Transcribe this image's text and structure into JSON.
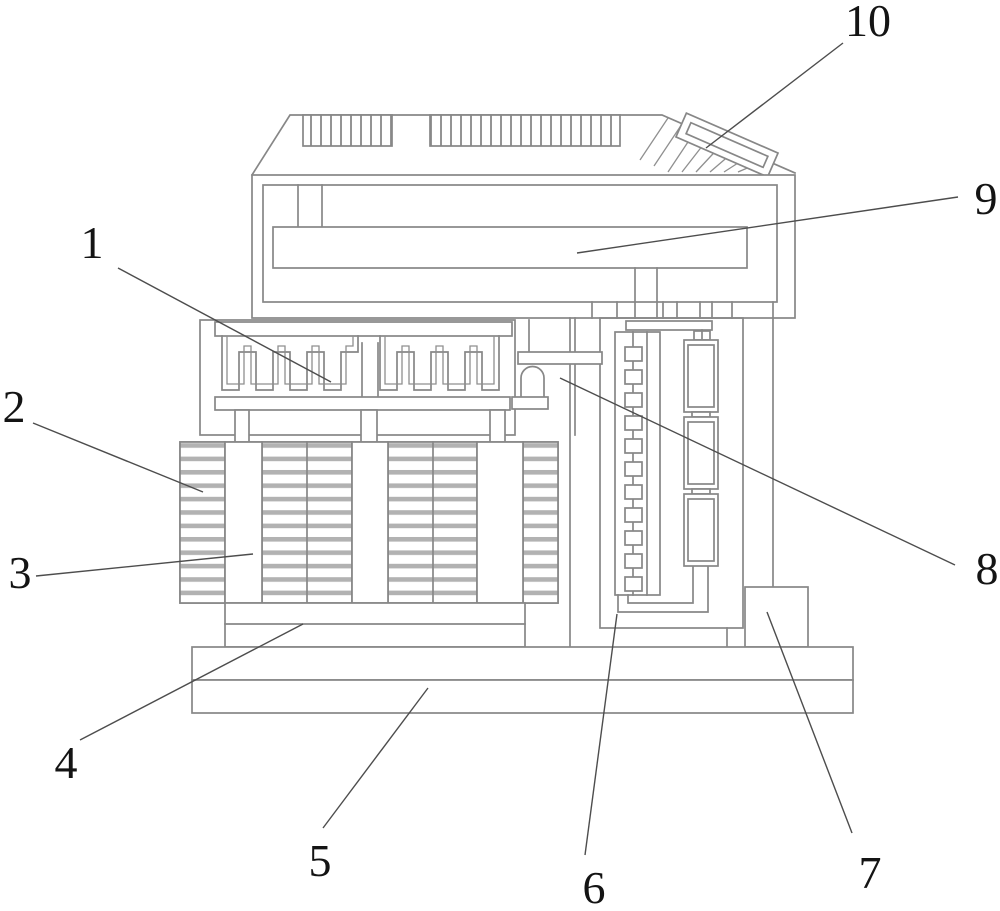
{
  "figure": {
    "kind": "patent-line-drawing",
    "background": "#ffffff",
    "line_color": "#878787",
    "leader_color": "#4d4d4d",
    "label_color": "#141414",
    "callouts": [
      {
        "label": "1",
        "x": 92,
        "y": 258,
        "leader": [
          118,
          268,
          331,
          382
        ]
      },
      {
        "label": "2",
        "x": 14,
        "y": 422,
        "leader": [
          33,
          423,
          203,
          492
        ]
      },
      {
        "label": "3",
        "x": 20,
        "y": 588,
        "leader": [
          36,
          576,
          253,
          554
        ]
      },
      {
        "label": "4",
        "x": 66,
        "y": 778,
        "leader": [
          80,
          740,
          303,
          624
        ]
      },
      {
        "label": "5",
        "x": 320,
        "y": 876,
        "leader": [
          323,
          828,
          428,
          688
        ]
      },
      {
        "label": "6",
        "x": 594,
        "y": 903,
        "leader": [
          585,
          855,
          617,
          614
        ]
      },
      {
        "label": "7",
        "x": 870,
        "y": 888,
        "leader": [
          852,
          833,
          767,
          612
        ]
      },
      {
        "label": "8",
        "x": 987,
        "y": 584,
        "leader": [
          955,
          565,
          560,
          378
        ]
      },
      {
        "label": "9",
        "x": 986,
        "y": 214,
        "leader": [
          958,
          197,
          577,
          253
        ]
      },
      {
        "label": "10",
        "x": 868,
        "y": 36,
        "leader": [
          843,
          43,
          706,
          148
        ]
      }
    ]
  }
}
